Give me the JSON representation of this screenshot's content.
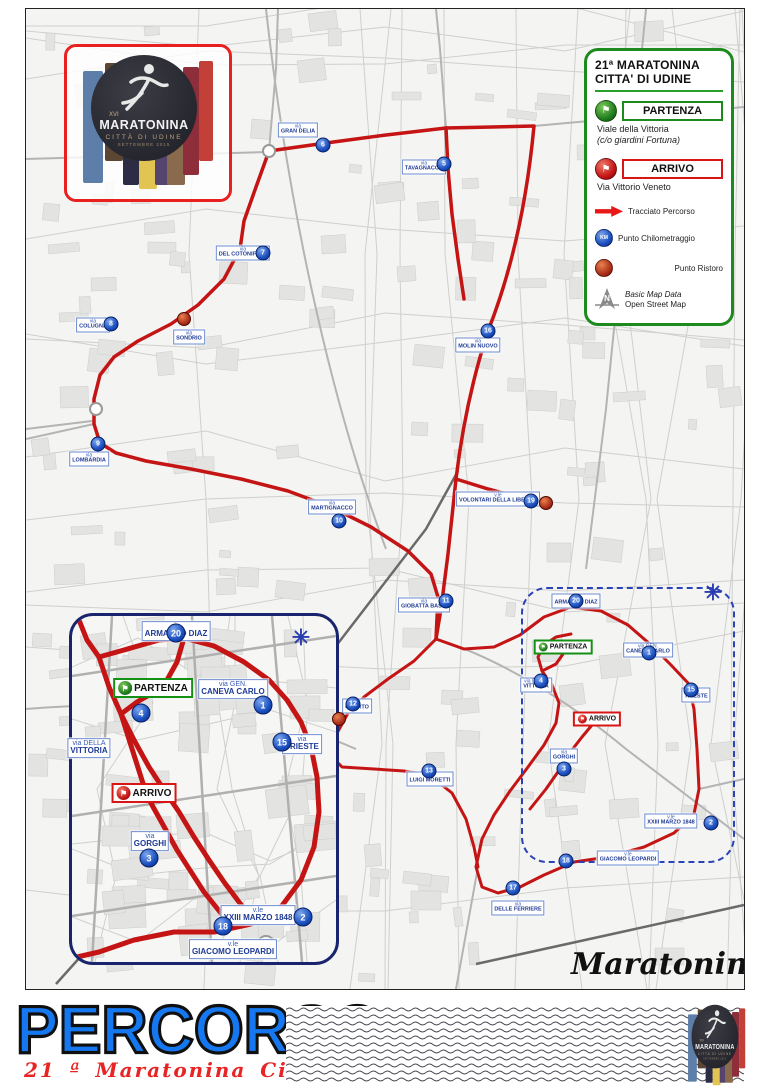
{
  "legend": {
    "title_line1": "21ª MARATONINA",
    "title_line2": "CITTA' DI UDINE",
    "partenza_label": "PARTENZA",
    "partenza_location1": "Viale della Vittoria",
    "partenza_location2": "(c/o giardini Fortuna)",
    "arrivo_label": "ARRIVO",
    "arrivo_location": "Via Vittorio Veneto",
    "route_label": "Tracciato Percorso",
    "km_label": "Punto Chilometraggio",
    "km_icon_text": "KM",
    "ristoro_label": "Punto Ristoro",
    "flag_glyph": "⚑",
    "credit_line1": "Basic Map Data",
    "credit_line2": "Open Street Map",
    "compass_letter": "N"
  },
  "logo": {
    "edition_roman": "XVI",
    "name": "MARATONINA",
    "city": "CITTÀ DI UDINE",
    "date": "SETTEMBRE 2015"
  },
  "signature": {
    "script_text": "Maratonina",
    "badge_text": "UD"
  },
  "footer": {
    "title": "PERCORSO",
    "subtitle": "21 ª Maratonina Città di Udine"
  },
  "colors": {
    "route_red": "#c41414",
    "legend_green": "#1d8a1d",
    "km_blue": "#1b50c0",
    "inset_border": "#18246e",
    "title_blue": "#1678f0",
    "subtitle_red": "#e82424"
  },
  "map": {
    "asterisk_symbol": "✳",
    "street_labels": [
      {
        "pre": "via",
        "name": "GRAN DELIA",
        "x": 272,
        "y": 121,
        "size": "s"
      },
      {
        "pre": "via",
        "name": "TAVAGNACCO",
        "x": 398,
        "y": 158,
        "size": "s"
      },
      {
        "pre": "via",
        "name": "DEL COTONIFICIO",
        "x": 217,
        "y": 244,
        "size": "s"
      },
      {
        "pre": "via",
        "name": "SONDRIO",
        "x": 163,
        "y": 328,
        "size": "s"
      },
      {
        "pre": "via",
        "name": "COLUGNA",
        "x": 67,
        "y": 316,
        "size": "s"
      },
      {
        "pre": "via",
        "name": "LOMBARDIA",
        "x": 63,
        "y": 450,
        "size": "s"
      },
      {
        "pre": "via",
        "name": "MARTIGNACCO",
        "x": 306,
        "y": 498,
        "size": "s"
      },
      {
        "pre": "via",
        "name": "MOLIN NUOVO",
        "x": 452,
        "y": 336,
        "size": "s"
      },
      {
        "pre": "v.le",
        "name": "VOLONTARI DELLA LIBERTA'",
        "x": 472,
        "y": 490,
        "size": "s"
      },
      {
        "pre": "via",
        "name": "GIOBATTA BASSI",
        "x": 398,
        "y": 596,
        "size": "s"
      },
      {
        "pre": "via",
        "name": "QUARTO",
        "x": 331,
        "y": 697,
        "size": "s"
      },
      {
        "pre": "via",
        "name": "LUIGI MORETTI",
        "x": 404,
        "y": 770,
        "size": "s"
      },
      {
        "pre": "via",
        "name": "ARMANDO DIAZ",
        "x": 550,
        "y": 592,
        "size": "s"
      },
      {
        "pre": "via DELLA",
        "name": "VITTORIA",
        "x": 510,
        "y": 676,
        "size": "s"
      },
      {
        "pre": "via GEN.",
        "name": "CANEVA CARLO",
        "x": 622,
        "y": 641,
        "size": "s"
      },
      {
        "pre": "via",
        "name": "TRIESTE",
        "x": 670,
        "y": 686,
        "size": "s"
      },
      {
        "pre": "via",
        "name": "GORGHI",
        "x": 538,
        "y": 747,
        "size": "s"
      },
      {
        "pre": "v.le",
        "name": "XXIII MARZO 1848",
        "x": 645,
        "y": 812,
        "size": "s"
      },
      {
        "pre": "v.le",
        "name": "GIACOMO LEOPARDI",
        "x": 602,
        "y": 849,
        "size": "s"
      },
      {
        "pre": "via",
        "name": "DELLE FERRIERE",
        "x": 492,
        "y": 899,
        "size": "s"
      },
      {
        "pre": "via",
        "name": "ARMANDO DIAZ",
        "x": 150,
        "y": 622,
        "size": "l"
      },
      {
        "pre": "via GEN.",
        "name": "CANEVA CARLO",
        "x": 207,
        "y": 680,
        "size": "l"
      },
      {
        "pre": "via DELLA",
        "name": "VITTORIA",
        "x": 63,
        "y": 739,
        "size": "l"
      },
      {
        "pre": "via",
        "name": "TRIESTE",
        "x": 276,
        "y": 735,
        "size": "l"
      },
      {
        "pre": "via",
        "name": "GORGHI",
        "x": 124,
        "y": 832,
        "size": "l"
      },
      {
        "pre": "v.le",
        "name": "XXIII MARZO 1848",
        "x": 232,
        "y": 906,
        "size": "l"
      },
      {
        "pre": "v.le",
        "name": "GIACOMO LEOPARDI",
        "x": 207,
        "y": 940,
        "size": "l"
      }
    ],
    "km_markers": [
      {
        "n": "5",
        "x": 418,
        "y": 155,
        "size": "s"
      },
      {
        "n": "6",
        "x": 297,
        "y": 136,
        "size": "s"
      },
      {
        "n": "7",
        "x": 237,
        "y": 244,
        "size": "s"
      },
      {
        "n": "8",
        "x": 85,
        "y": 315,
        "size": "s"
      },
      {
        "n": "9",
        "x": 72,
        "y": 435,
        "size": "s"
      },
      {
        "n": "10",
        "x": 313,
        "y": 512,
        "size": "s"
      },
      {
        "n": "11",
        "x": 420,
        "y": 592,
        "size": "s"
      },
      {
        "n": "16",
        "x": 462,
        "y": 322,
        "size": "s"
      },
      {
        "n": "19",
        "x": 505,
        "y": 492,
        "size": "s"
      },
      {
        "n": "12",
        "x": 327,
        "y": 695,
        "size": "s"
      },
      {
        "n": "13",
        "x": 403,
        "y": 762,
        "size": "s"
      },
      {
        "n": "20",
        "x": 550,
        "y": 592,
        "size": "s"
      },
      {
        "n": "1",
        "x": 623,
        "y": 644,
        "size": "s"
      },
      {
        "n": "15",
        "x": 665,
        "y": 681,
        "size": "s"
      },
      {
        "n": "4",
        "x": 515,
        "y": 672,
        "size": "s"
      },
      {
        "n": "3",
        "x": 538,
        "y": 760,
        "size": "s"
      },
      {
        "n": "2",
        "x": 685,
        "y": 814,
        "size": "s"
      },
      {
        "n": "17",
        "x": 487,
        "y": 879,
        "size": "s"
      },
      {
        "n": "18",
        "x": 540,
        "y": 852,
        "size": "s"
      },
      {
        "n": "20",
        "x": 150,
        "y": 624,
        "size": "l"
      },
      {
        "n": "1",
        "x": 237,
        "y": 696,
        "size": "l"
      },
      {
        "n": "15",
        "x": 256,
        "y": 733,
        "size": "l"
      },
      {
        "n": "4",
        "x": 115,
        "y": 704,
        "size": "l"
      },
      {
        "n": "3",
        "x": 123,
        "y": 849,
        "size": "l"
      },
      {
        "n": "2",
        "x": 277,
        "y": 908,
        "size": "l"
      },
      {
        "n": "18",
        "x": 197,
        "y": 917,
        "size": "l"
      }
    ],
    "ristoro_markers": [
      {
        "x": 158,
        "y": 310
      },
      {
        "x": 520,
        "y": 494
      },
      {
        "x": 313,
        "y": 710
      }
    ],
    "flags": [
      {
        "type": "partenza",
        "label": "PARTENZA",
        "x": 537,
        "y": 638,
        "size": "s"
      },
      {
        "type": "arrivo",
        "label": "ARRIVO",
        "x": 571,
        "y": 710,
        "size": "s"
      },
      {
        "type": "partenza",
        "label": "PARTENZA",
        "x": 127,
        "y": 679,
        "size": "l"
      },
      {
        "type": "arrivo",
        "label": "ARRIVO",
        "x": 118,
        "y": 784,
        "size": "l"
      }
    ],
    "asterisks": [
      {
        "x": 687,
        "y": 584
      },
      {
        "x": 275,
        "y": 629
      }
    ]
  }
}
